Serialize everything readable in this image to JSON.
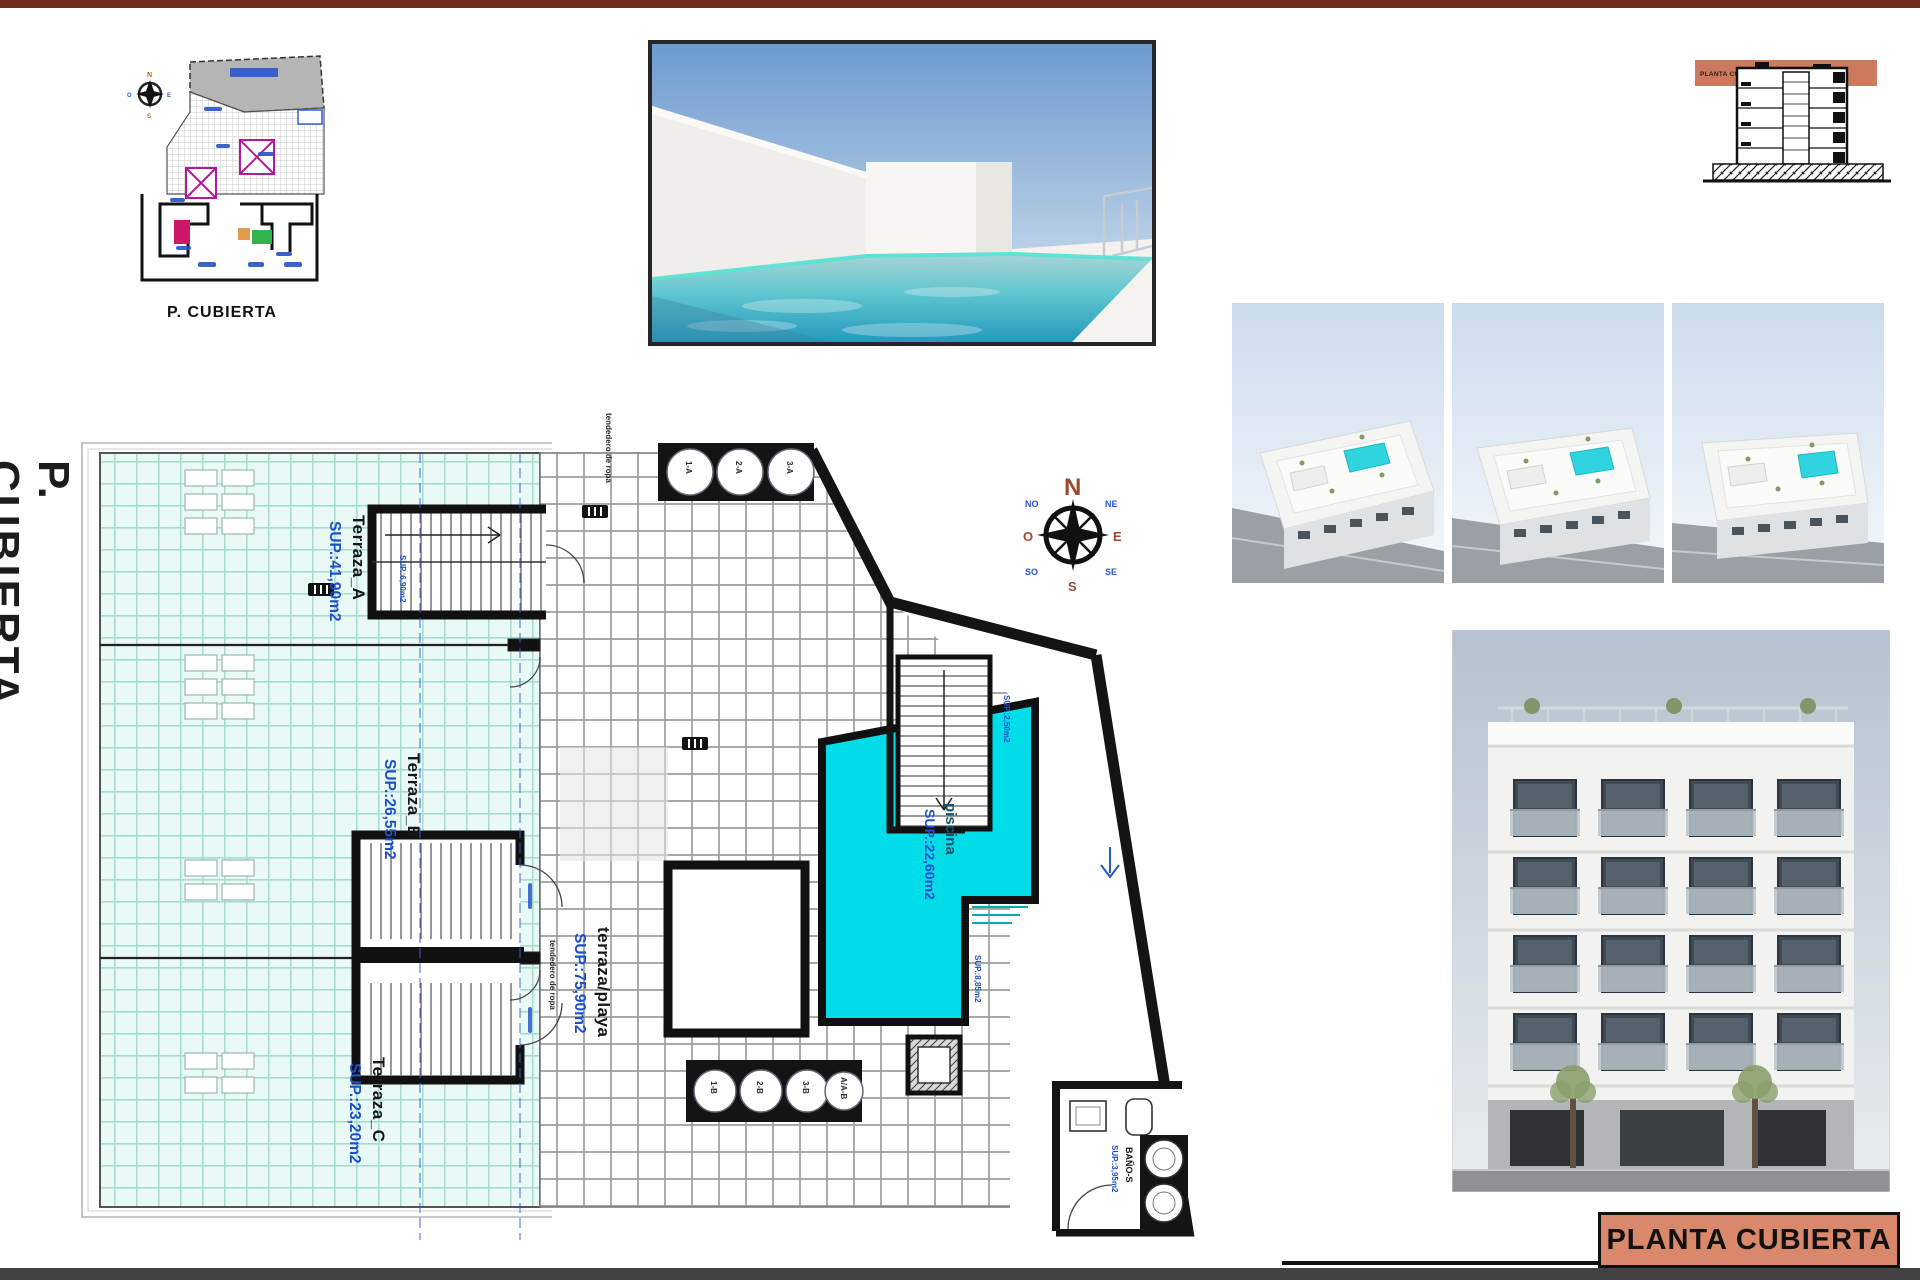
{
  "sheet": {
    "colors": {
      "bar_maroon": "#722c1e",
      "accent_salmon": "#d9886b",
      "pool_cyan": "#00dce8",
      "label_blue": "#1d4fc8",
      "terrace_mint": "#e9faf6"
    }
  },
  "side_label": {
    "text": "P. CUBIERTA"
  },
  "site_plan": {
    "caption": "P. CUBIERTA"
  },
  "section_drawing": {
    "band_label": "PLANTA CUBIERTA"
  },
  "title_block": {
    "label": "PLANTA CUBIERTA"
  },
  "compass": {
    "n": "N",
    "s": "S",
    "e": "E",
    "o": "O",
    "ne": "NE",
    "no": "NO",
    "se": "SE",
    "so": "SO"
  },
  "plan": {
    "terraces": [
      {
        "name": "Terraza_A",
        "area": "SUP.:41,90m2"
      },
      {
        "name": "Terraza_B",
        "area": "SUP.:26,55m2"
      },
      {
        "name": "Terraza_C",
        "area": "SUP.:23,20m2"
      }
    ],
    "deck": {
      "name": "terraza/playa",
      "area": "SUP.:75,90m2"
    },
    "pool": {
      "name": "piscina",
      "area": "SUP.:22,60m2"
    },
    "bath": {
      "name": "BAÑO-S",
      "area": "SUP.:3,95m2"
    },
    "small_labels": {
      "stair_top": "SUP.:6,90m2",
      "stair_right": "SUP.:2,50m2",
      "deck_side": "SUP.:8,85m2",
      "clothesline_top": "tendedero de ropa",
      "clothesline_mid": "tendedero de ropa"
    },
    "vents_top": [
      "1-A",
      "2-A",
      "3-A"
    ],
    "vents_bottom": [
      "1-B",
      "2-B",
      "3-B",
      "A/A-B"
    ]
  }
}
